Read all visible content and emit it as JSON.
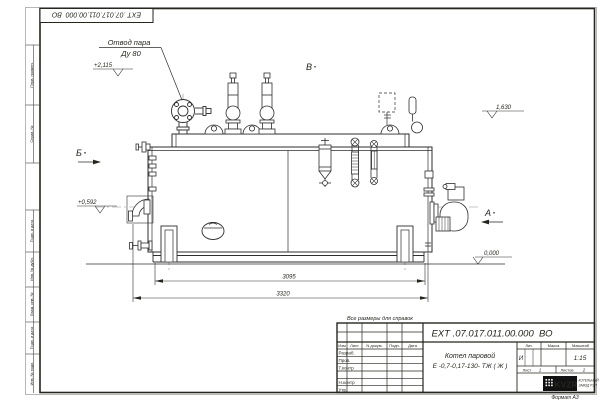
{
  "frame": {
    "corner_stamp": "ЕХТ .07.017.011.00.000  ВО",
    "left_stamps": [
      "Перв. примен.",
      "Справ. №",
      "Подп. и дата",
      "Инв. № дубл.",
      "Взам. инв. №",
      "Подп. и дата",
      "Инв. № подл."
    ],
    "format_note": "Формат А3"
  },
  "note": "Все размеры для справок",
  "drawing": {
    "callout_line1": "Отвод пара",
    "callout_line2": "Ду 80",
    "view_b": "Б",
    "view_v": "В",
    "view_a": "А",
    "elev_steam": "+2,115",
    "elev_axis": "+0,592",
    "elev_top": "1,630",
    "elev_ground": "0,000",
    "dim_inner": "3095",
    "dim_outer": "3320"
  },
  "title_block": {
    "designation": "ЕХТ .07.017.011.00.000  ВО",
    "product_line1": "Котел паровой",
    "product_line2": "Е -0,7-0,17-130- ТЖ ( Ж )",
    "col_izm": "Изм",
    "col_list": "Лист",
    "col_docum": "N докум.",
    "col_podp": "Подп.",
    "col_data": "Дата",
    "row_razrab": "Разраб.",
    "row_prov": "Пров.",
    "row_tkontr": "Т.контр",
    "row_nkontr": "Н.контр",
    "row_utv": "Утв.",
    "lit_label": "Лит.",
    "mass_label": "Масса",
    "scale_label": "Масштаб",
    "lit_value": "И",
    "scale_value": "1:15",
    "sheet_label": "Лист",
    "sheet_value": "1",
    "sheets_label": "Листов",
    "sheets_value": "2",
    "logo_text": "KVZR",
    "company_line1": "КОТЕЛЬНЫЙ",
    "company_line2": "ЗАВОД РЭП"
  }
}
